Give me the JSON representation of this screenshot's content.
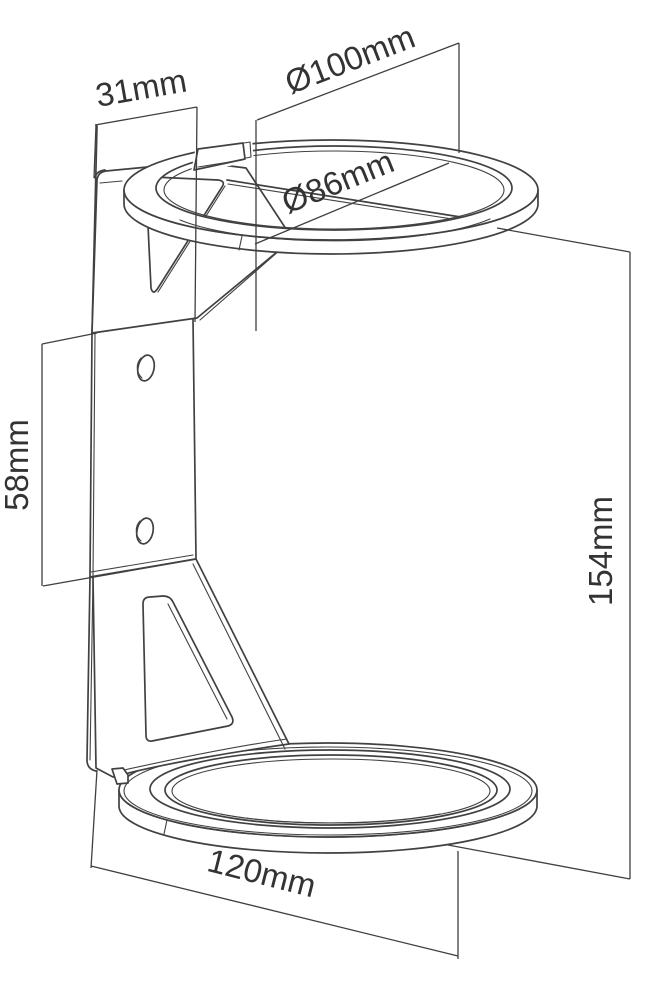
{
  "diagram": {
    "title": "speaker wall mount bracket technical drawing",
    "type": "isometric line drawing with dimensions",
    "dimensions": [
      {
        "id": "wall-offset",
        "label": "31mm",
        "value": 31,
        "unit": "mm",
        "measures": "offset of clamp ring front from wall plate"
      },
      {
        "id": "outer-diameter",
        "label": "Ø100mm",
        "value": 100,
        "unit": "mm",
        "measures": "outer diameter of top clamp ring"
      },
      {
        "id": "inner-diameter",
        "label": "Ø86mm",
        "value": 86,
        "unit": "mm",
        "measures": "inner diameter of top clamp ring"
      },
      {
        "id": "hole-spacing",
        "label": "58mm",
        "value": 58,
        "unit": "mm",
        "measures": "height of flat wall-plate section / screw hole span"
      },
      {
        "id": "total-height",
        "label": "154mm",
        "value": 154,
        "unit": "mm",
        "measures": "overall height from top ring to base tray"
      },
      {
        "id": "base-diameter",
        "label": "120mm",
        "value": 120,
        "unit": "mm",
        "measures": "diameter of bottom support tray"
      }
    ]
  },
  "colors": {
    "line_color": "#414141",
    "dim_color": "#3f3f3f",
    "text_color": "#333333",
    "bg_color": "#ffffff"
  }
}
